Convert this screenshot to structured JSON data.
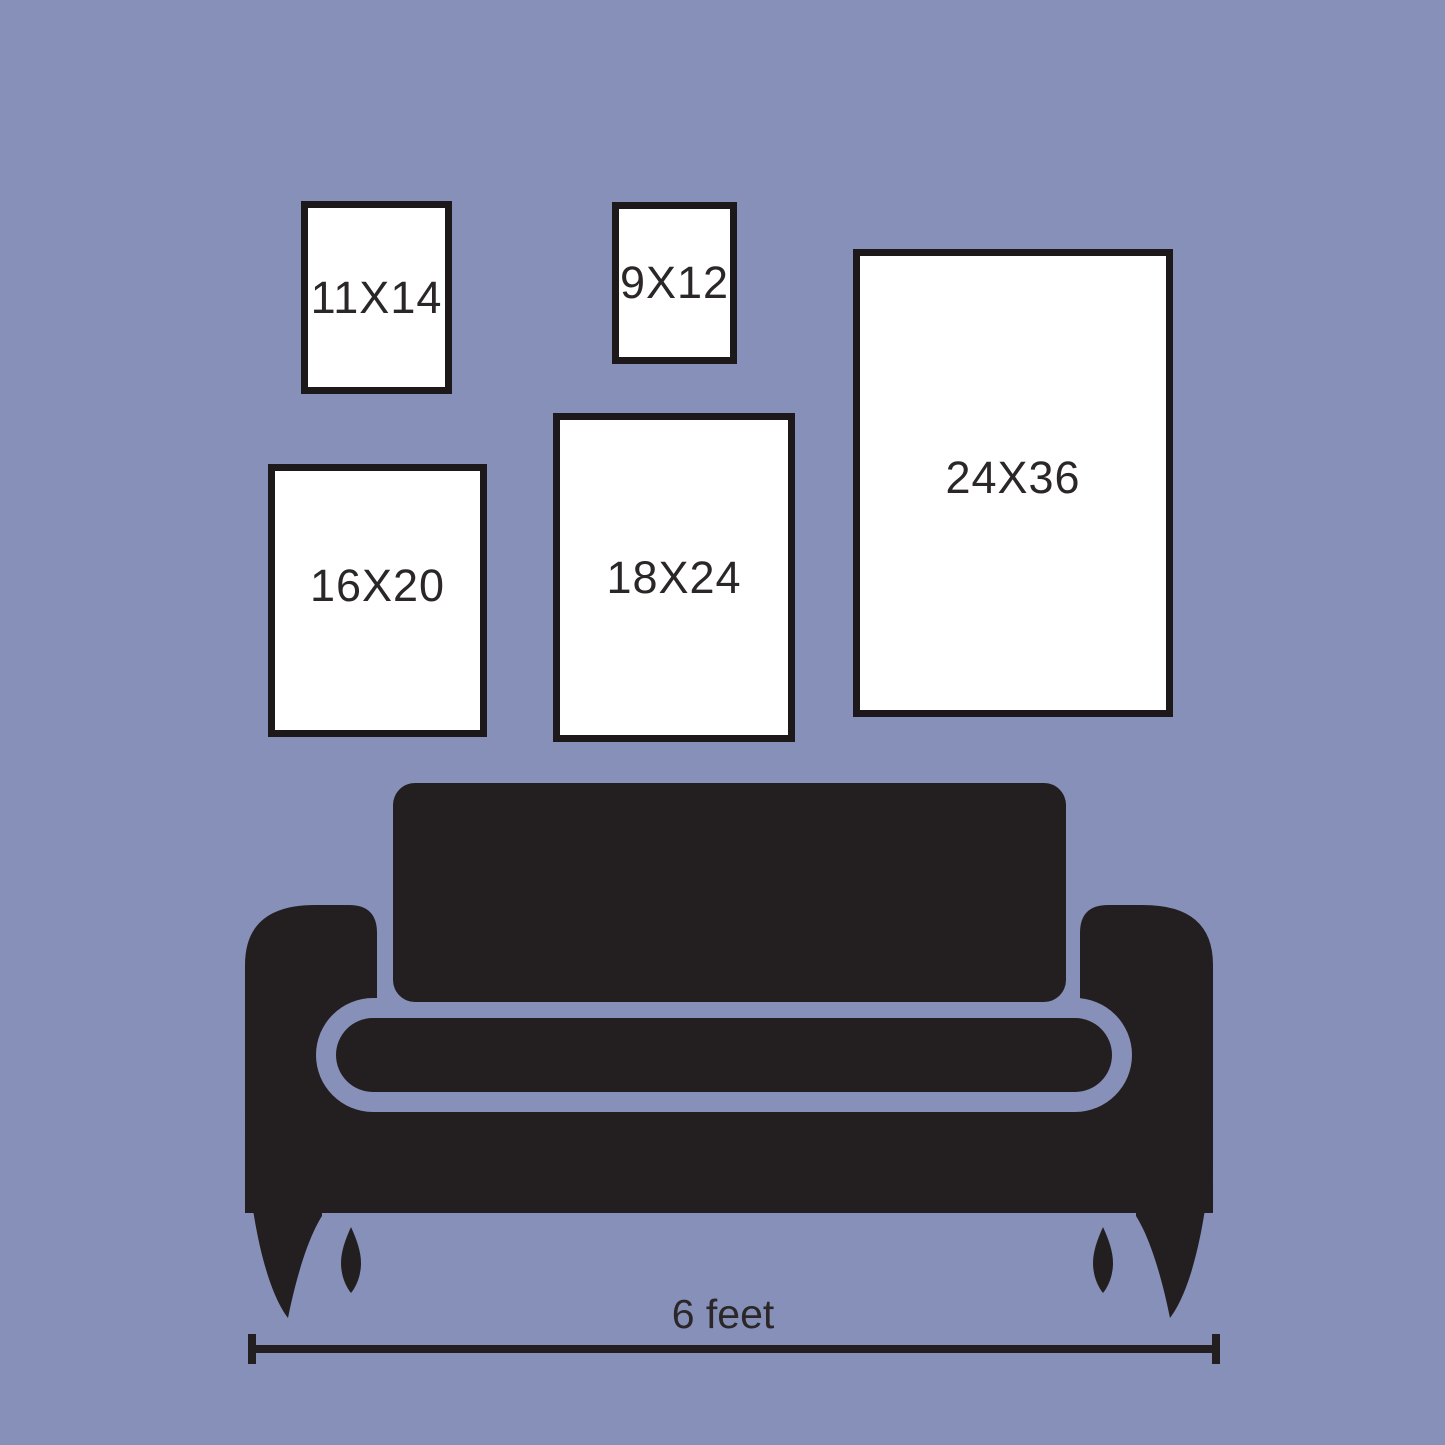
{
  "frames": [
    {
      "id": "11x14",
      "label": "11X14"
    },
    {
      "id": "9x12",
      "label": "9X12"
    },
    {
      "id": "16x20",
      "label": "16X20"
    },
    {
      "id": "18x24",
      "label": "18X24"
    },
    {
      "id": "24x36",
      "label": "24X36"
    }
  ],
  "measurement": {
    "label": "6 feet"
  },
  "colors": {
    "background": "#8790B8",
    "sofa": "#231F20",
    "frame_fill": "#FFFFFF",
    "frame_border": "#1D191A",
    "text": "#2B2728"
  }
}
